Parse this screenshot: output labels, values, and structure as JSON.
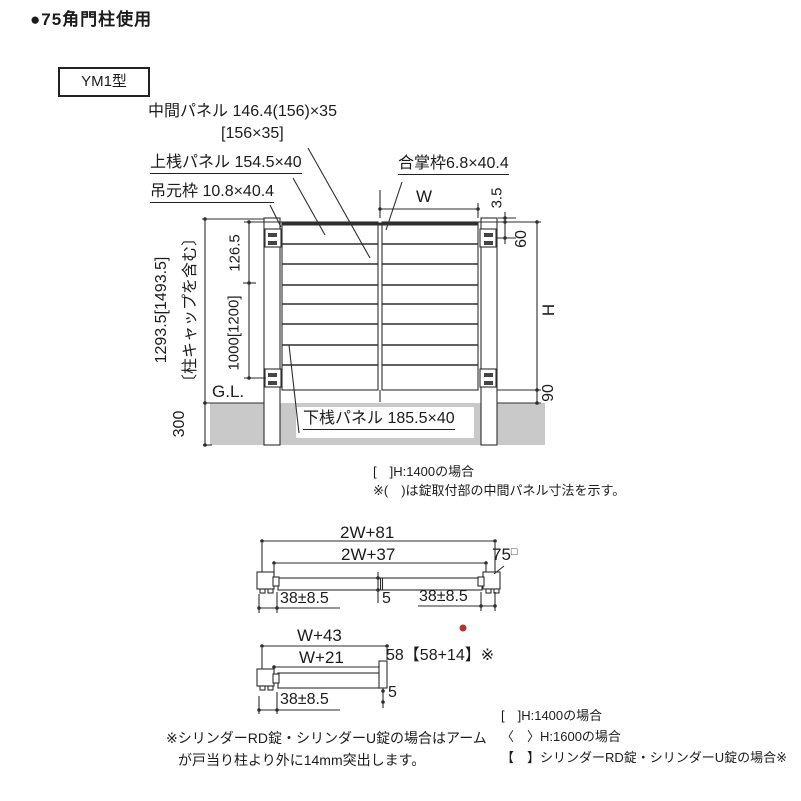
{
  "title": "●75角門柱使用",
  "model_label": "YM1型",
  "elevation": {
    "labels": {
      "middle_panel": "中間パネル 146.4(156)×35",
      "middle_panel_bracket": "[156×35]",
      "top_rail_panel": "上桟パネル 154.5×40",
      "hinge_frame": "吊元枠 10.8×40.4",
      "meeting_frame": "合掌枠6.8×40.4",
      "bottom_rail_panel": "下桟パネル 185.5×40",
      "ground_line": "G.L."
    },
    "dims": {
      "total_height": "1293.5[1493.5]",
      "total_height_note": "〔柱キャップを含む〕",
      "top_section": "126.5",
      "hinge_span": "1000[1200]",
      "embed": "300",
      "leaf_width": "W",
      "cap_clearance": "3.5",
      "top_hinge_offset": "60",
      "gate_height": "H",
      "bottom_clearance": "90"
    }
  },
  "mid_notes": [
    "[　]H:1400の場合",
    "※(　)は錠取付部の中間パネル寸法を示す。"
  ],
  "plan_double": {
    "overall_width": "2W+81",
    "panel_width": "2W+37",
    "post_size": "75",
    "post_size_mark": "□",
    "left_gap": "38±8.5",
    "right_gap": "38±8.5",
    "center_gap": "5"
  },
  "plan_single": {
    "overall_width": "W+43",
    "panel_width": "W+21",
    "depth": "58【58+14】※",
    "end_gap": "5",
    "left_gap": "38±8.5"
  },
  "bottom_left_notes": [
    "※シリンダーRD錠・シリンダーU錠の場合はアーム",
    "が戸当り柱より外に14mm突出します。"
  ],
  "bottom_right_notes": [
    "[　]H:1400の場合",
    "〈　〉H:1600の場合",
    "【　】シリンダーRD錠・シリンダーU錠の場合※"
  ]
}
